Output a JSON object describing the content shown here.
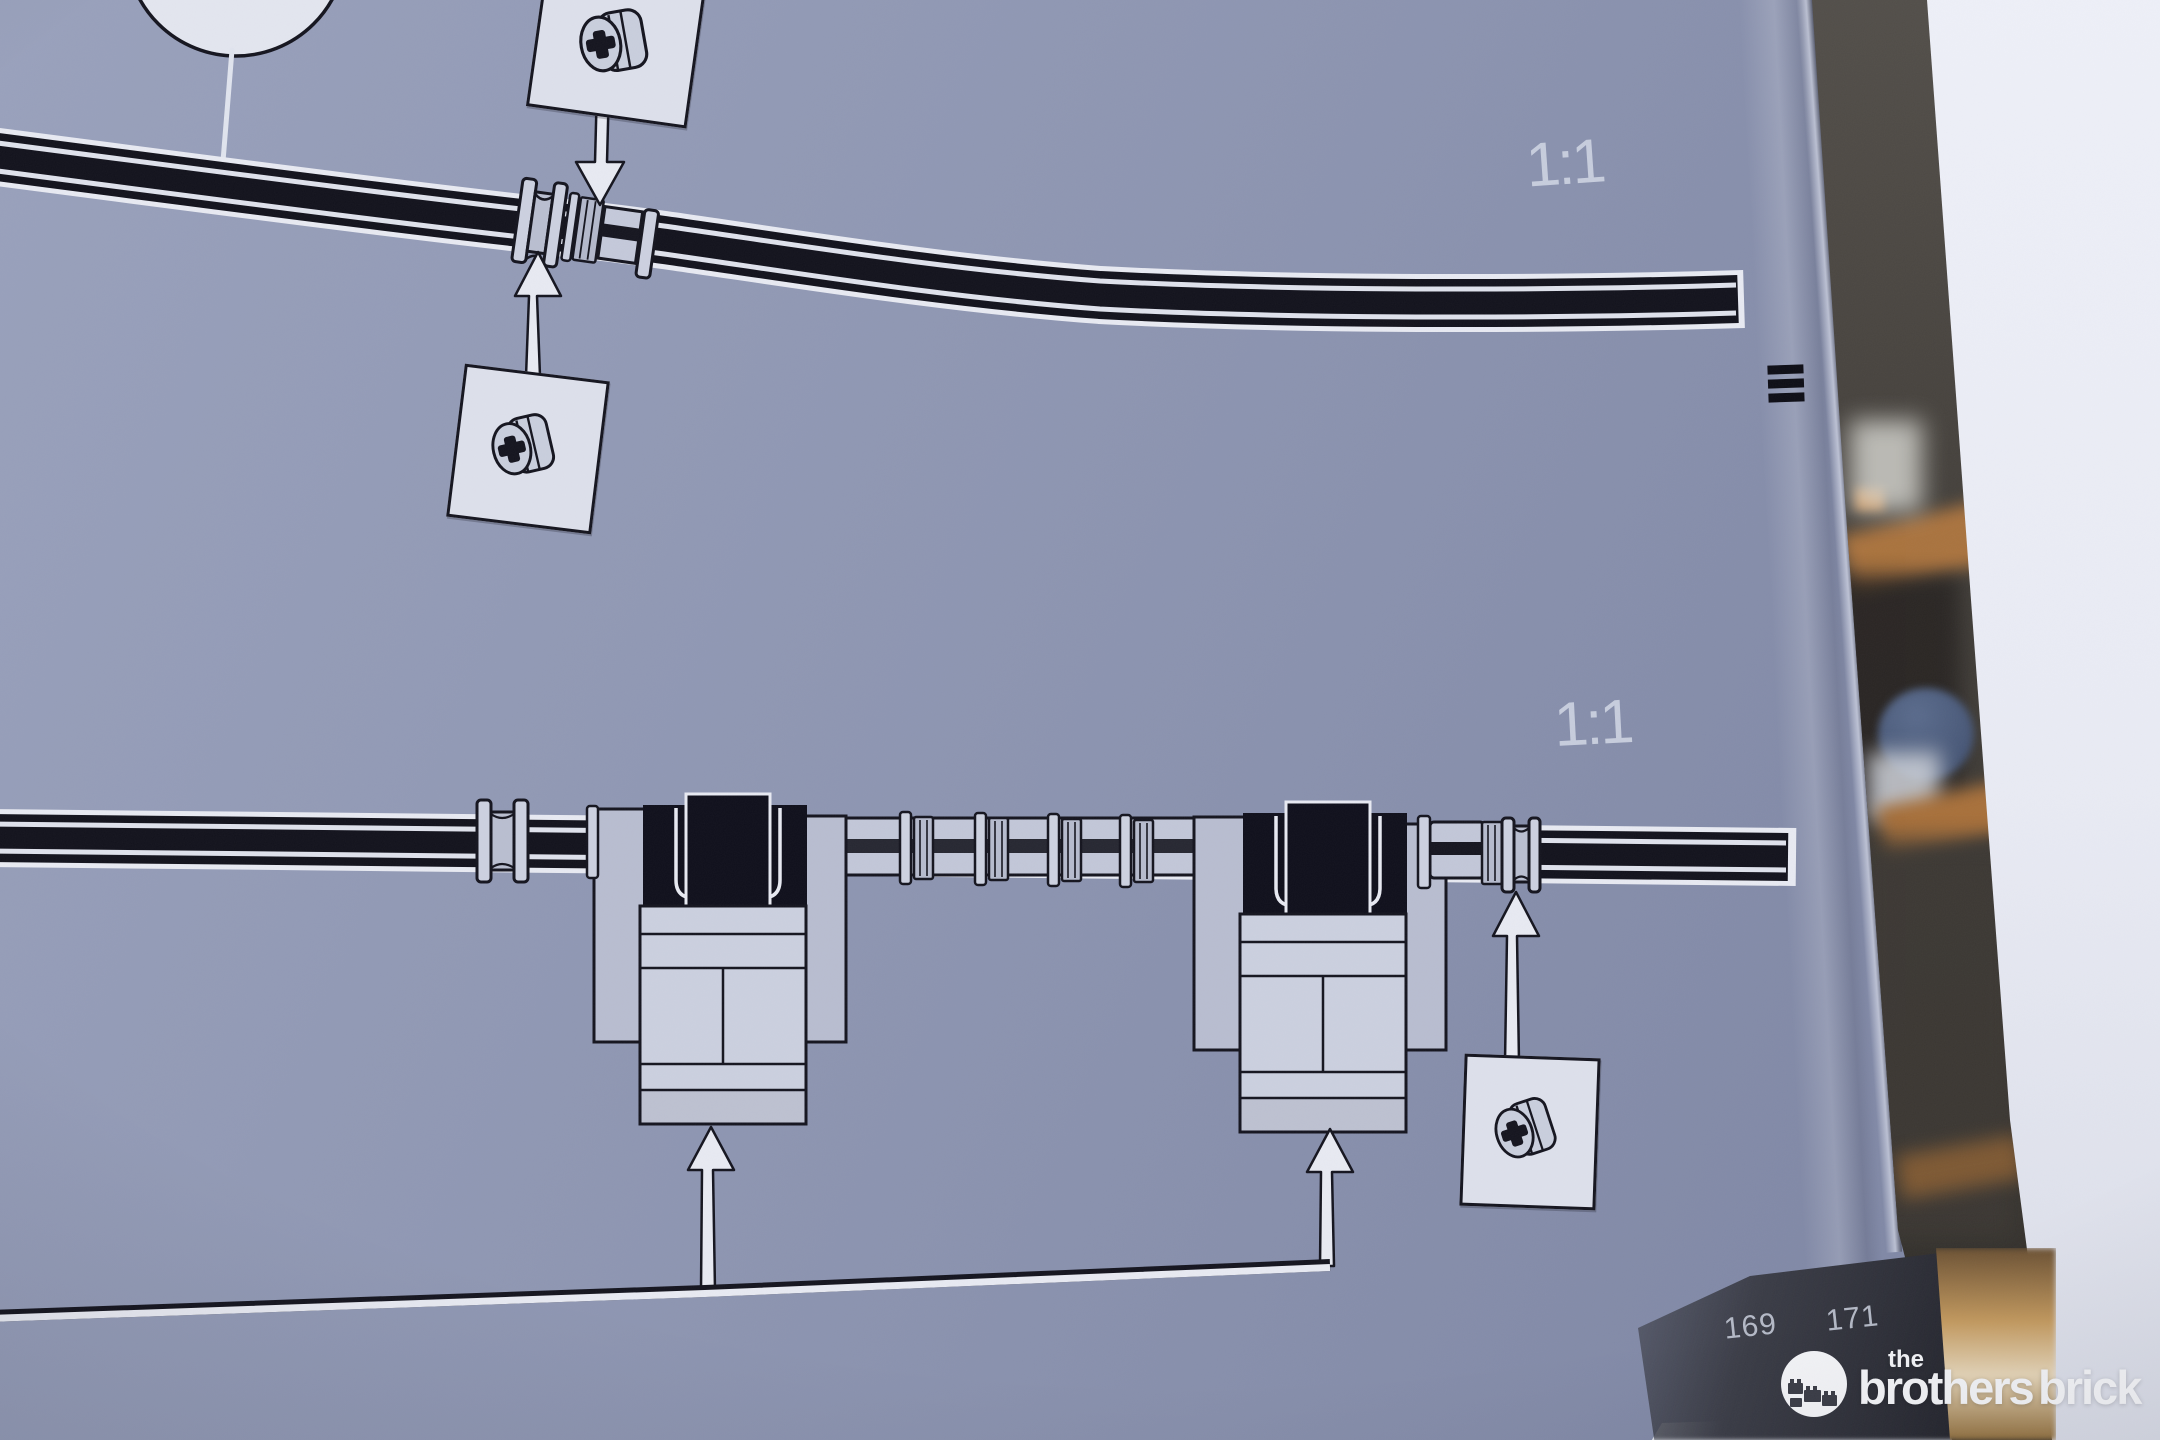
{
  "labels": {
    "scale_top": "1:1",
    "scale_bottom": "1:1"
  },
  "page_numbers": {
    "left": "169",
    "right": "171"
  },
  "watermark": {
    "word_the": "the",
    "word_brothers": "brothers",
    "word_brick": "brick"
  },
  "parts": {
    "callout_top_part": "technic-bush",
    "callout_middle_part": "technic-bush",
    "callout_bottom_part": "technic-bush"
  },
  "colors": {
    "paper": "#8d95b1",
    "paper_light": "#99a1bc",
    "paper_dark": "#7c84a2",
    "ink": "#14141e",
    "print_white": "#e8eaf2",
    "piece_light": "#ccd1e0",
    "piece_mid": "#b6bbcd",
    "piece_dark": "#0f0f1b",
    "label_gray": "#cdd3e2",
    "page_number_gray": "#b4b9c6",
    "corner_dark": "#32343d",
    "background_dark": "#46423d",
    "wood": "#b5793f",
    "bowl_blue": "#3e4d6c",
    "gold": "#c49a5e",
    "white_panel": "#e9ebf4",
    "logo_white": "#f4f5f8"
  }
}
